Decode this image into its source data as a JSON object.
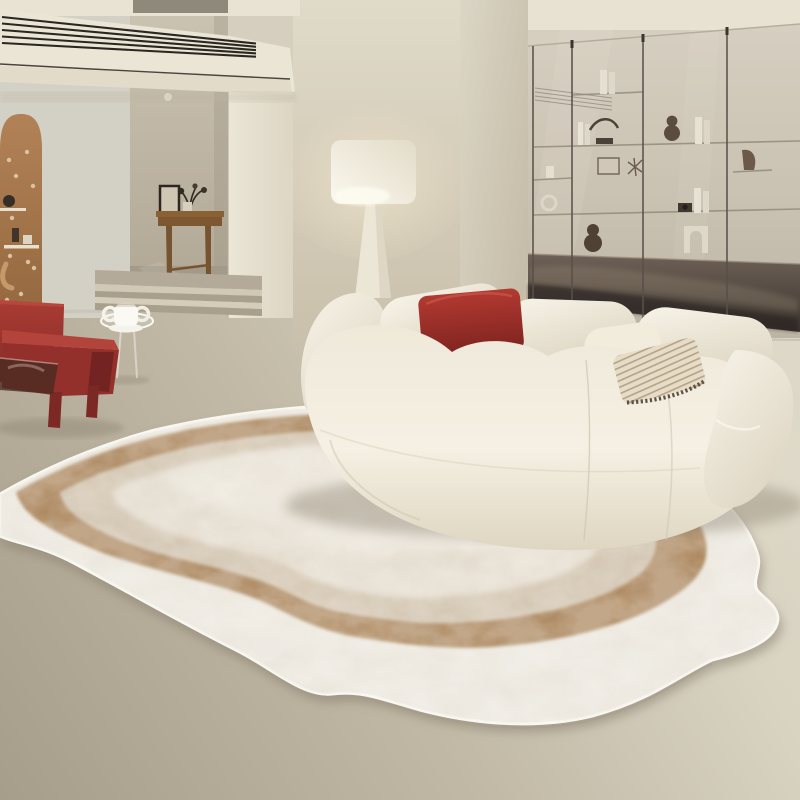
{
  "scene": {
    "type": "interior-product-photo",
    "description": "Cream minimalist living room with an irregular organic-shaped area rug in white, caramel and beige layers, a beige modular sofa with a red cushion, a dark-red armchair, a glass side table with a white mug, an arched wooden pegboard, a console table, steps, a glowing floor lamp and a smoked-glass shelving partition.",
    "objects": [
      {
        "name": "vent-beam",
        "label": "Overhead beam with linear air vent"
      },
      {
        "name": "arch-pegboard",
        "label": "Arched wooden pegboard with shelves"
      },
      {
        "name": "console-table",
        "label": "Wooden console table with frame and plant"
      },
      {
        "name": "stairs",
        "label": "Two low steps from hallway"
      },
      {
        "name": "floor-lamp",
        "label": "Floor lamp with glowing drum shade"
      },
      {
        "name": "glass-partition",
        "label": "Smoked glass partition with display shelves"
      },
      {
        "name": "sofa",
        "label": "Cream modular fabric sofa"
      },
      {
        "name": "red-pillow",
        "label": "Red throw pillow"
      },
      {
        "name": "striped-pillow",
        "label": "Striped fringe pillow"
      },
      {
        "name": "armchair",
        "label": "Dark red lounge armchair"
      },
      {
        "name": "side-table",
        "label": "Round glass side table"
      },
      {
        "name": "mug",
        "label": "White double-handle mug"
      },
      {
        "name": "rug",
        "label": "Irregular wavy layered area rug"
      }
    ]
  },
  "palette": {
    "wall": "#d6cfc0",
    "wall-warm": "#c9c0ab",
    "ceiling": "#e8e2d3",
    "beam": "#ebe5d5",
    "slat": "#2a2722",
    "floor-light": "#d9d3c2",
    "floor-dark": "#a69e8a",
    "arch-wood": "#ad7c51",
    "table-wood": "#8a6134",
    "chair-red": "#9e3530",
    "chair-red-bright": "#b2443b",
    "chair-red-dark": "#7c2824",
    "cushion-cream": "#ddd2b8",
    "sofa-light": "#f6f2e6",
    "sofa-shade": "#ddd4c0",
    "pillow-red": "#a93228",
    "stripe-pillow": "#e3d9c4",
    "lamp-shade": "#fbf8ee",
    "lamp-base": "#ece6d6",
    "glass-tint": "#cdc5b5",
    "rod": "#57514a",
    "dark-band": "#4a4239",
    "rug-white": "#f1ede4",
    "rug-brown": "#a98155",
    "rug-tan": "#d3c4ae",
    "rug-cream": "#e8e0d2",
    "rug-center": "#f0eadf",
    "mug-white": "#f6f3ec"
  }
}
